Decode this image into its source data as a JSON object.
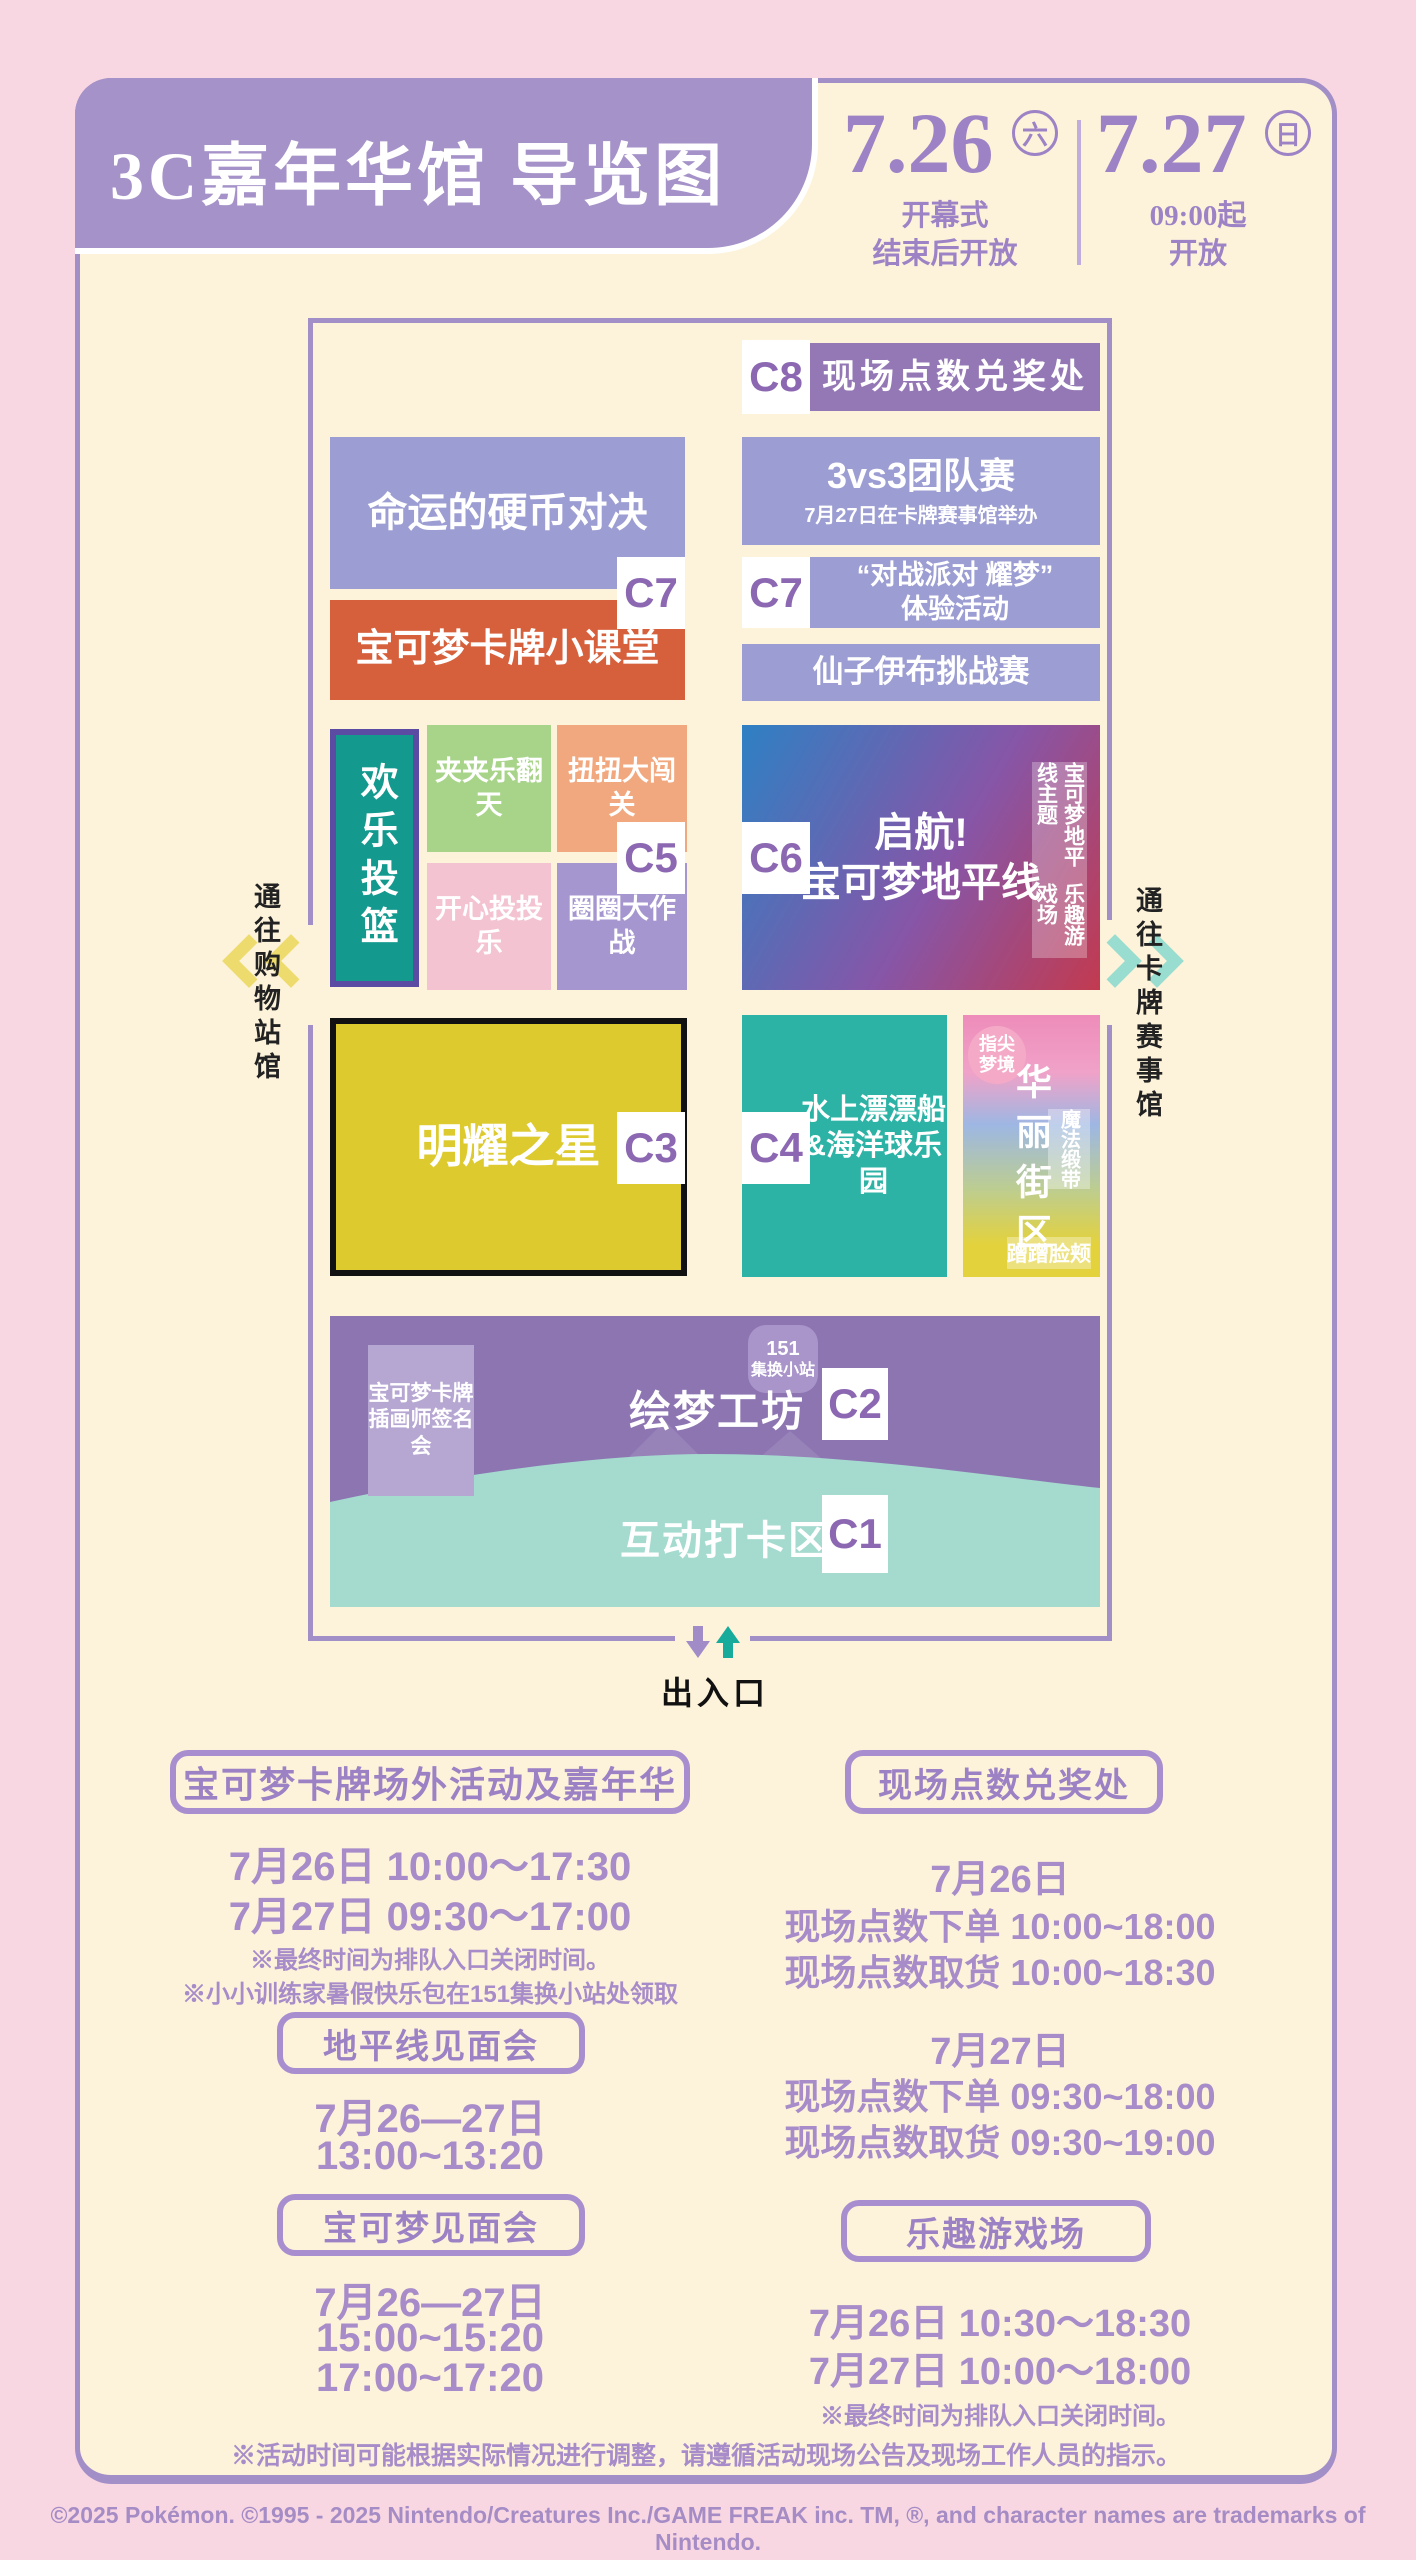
{
  "header": {
    "title": "3C嘉年华馆 导览图",
    "date1": {
      "num": "7.26",
      "day": "六",
      "sub1": "开幕式",
      "sub2": "结束后开放"
    },
    "date2": {
      "num": "7.27",
      "day": "日",
      "sub1": "09:00起",
      "sub2": "开放"
    }
  },
  "map": {
    "c8": {
      "label": "C8",
      "name": "现场点数兑奖处"
    },
    "coin": "命运的硬币对决",
    "c7l": "C7",
    "tcg_class": "宝可梦卡牌小课堂",
    "team": {
      "name": "3vs3团队赛",
      "sub": "7月27日在卡牌赛事馆举办"
    },
    "c7r": "C7",
    "battle": {
      "line1": "“对战派对 耀梦”",
      "line2": "体验活动"
    },
    "sylveon": "仙子伊布挑战赛",
    "hoops": "欢乐投篮",
    "claw": "夹夹乐翻天",
    "twist": "扭扭大闯关",
    "c5": "C5",
    "toss": "开心投投乐",
    "rings": "圈圈大作战",
    "c6": "C6",
    "horizons": {
      "line1": "启航!",
      "line2": "宝可梦地平线"
    },
    "funfair_tag": {
      "line1": "宝可梦地平线主题",
      "line2": "乐趣游戏场"
    },
    "star": "明耀之星",
    "c3": "C3",
    "c4": "C4",
    "water": {
      "line1": "水上漂漂船",
      "line2": "&海洋球乐园"
    },
    "glam": {
      "name": "华丽街区",
      "fingertip1": "指尖",
      "fingertip2": "梦境",
      "ribbon": "魔法缎带",
      "cheek": "蹭蹭脸颊"
    },
    "artist": {
      "line1": "宝可梦卡牌",
      "line2": "插画师签名会"
    },
    "badge151": {
      "line1": "151",
      "line2": "集换小站"
    },
    "dream": "绘梦工坊",
    "c2": "C2",
    "photo": "互动打卡区",
    "c1": "C1",
    "west": "通往购物站馆",
    "east": "通往卡牌赛事馆",
    "entrance": "出入口"
  },
  "sections": {
    "carnival": {
      "title": "宝可梦卡牌场外活动及嘉年华",
      "line1": "7月26日  10:00～17:30",
      "line2": "7月27日  09:30～17:00",
      "note1": "※最终时间为排队入口关闭时间。",
      "note2": "※小小训练家暑假快乐包在151集换小站处领取"
    },
    "horizon_meet": {
      "title": "地平线见面会",
      "line1": "7月26—27日",
      "line2": "13:00~13:20"
    },
    "pokemon_meet": {
      "title": "宝可梦见面会",
      "line1": "7月26—27日",
      "line2": "15:00~15:20",
      "line3": "17:00~17:20"
    },
    "points": {
      "title": "现场点数兑奖处",
      "day1": "7月26日",
      "d1r1": "现场点数下单  10:00~18:00",
      "d1r2": "现场点数取货  10:00~18:30",
      "day2": "7月27日",
      "d2r1": "现场点数下单  09:30~18:00",
      "d2r2": "现场点数取货  09:30~19:00"
    },
    "funfair": {
      "title": "乐趣游戏场",
      "line1": "7月26日  10:30～18:30",
      "line2": "7月27日  10:00～18:00",
      "note": "※最终时间为排队入口关闭时间。"
    }
  },
  "bottom_note": "※活动时间可能根据实际情况进行调整，请遵循活动现场公告及现场工作人员的指示。",
  "footer": "©2025 Pokémon. ©1995 - 2025 Nintendo/Creatures Inc./GAME FREAK inc. TM, ®, and character names are trademarks of Nintendo.",
  "colors": {
    "page_bg": "#f8d7e3",
    "card_bg": "#fdf3da",
    "purple": "#a38fc7",
    "header_purple": "#a592c8",
    "date_purple": "#9d83c6",
    "periwinkle": "#9c9dd2",
    "deep_purple": "#9478b5",
    "orange": "#d7603c",
    "teal": "#13998e",
    "teal_light": "#2db3a5",
    "green": "#a8d489",
    "salmon": "#f2a87e",
    "pink": "#f4c3d1",
    "lavender": "#a596d0",
    "yellow": "#ddca2f",
    "mint": "#a5dacf",
    "bottom_purple": "#8d75b2",
    "gradient_blue": "#2e80c3",
    "gradient_red": "#c23a50",
    "label_purple": "#8c68b2",
    "text_purple": "#a78cc9"
  }
}
